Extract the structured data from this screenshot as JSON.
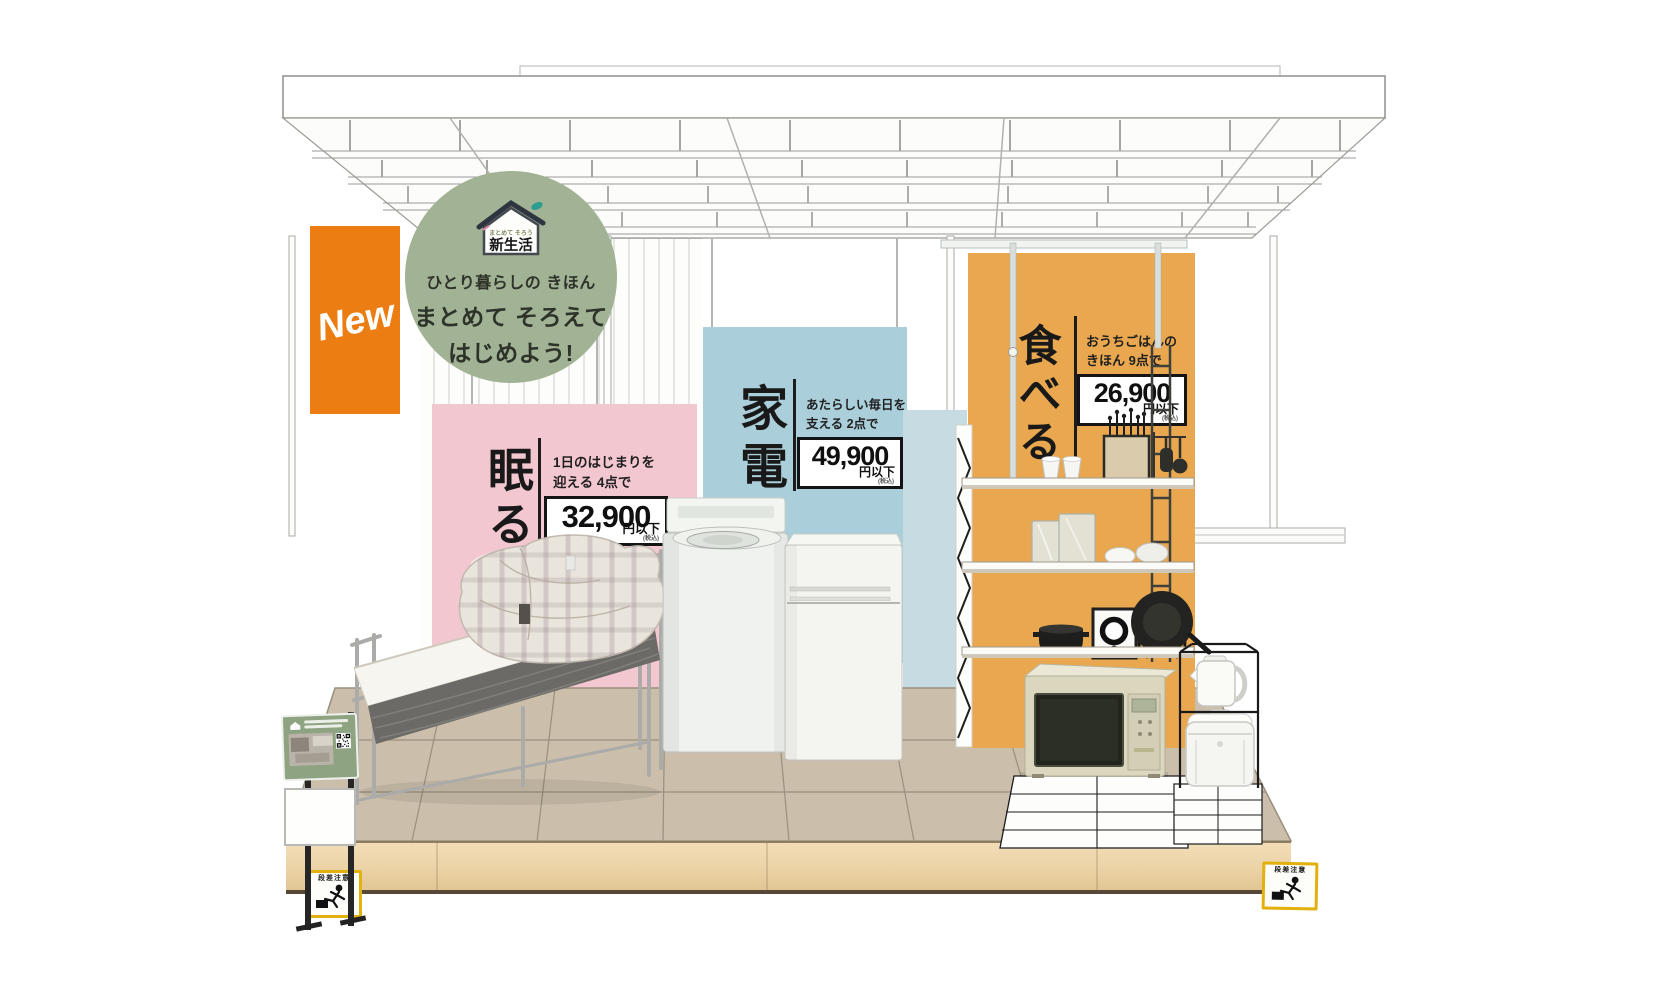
{
  "new_banner": {
    "label": "New"
  },
  "badge": {
    "logo_small": "まとめて そろう",
    "logo_main": "新生活",
    "tagline": "ひとり暮らしの きほん",
    "headline_line1": "まとめて そろえて",
    "headline_line2": "はじめよう!"
  },
  "sections": {
    "sleep": {
      "heading": "眠る",
      "desc1": "1日のはじまりを",
      "desc2": "迎える 4点で",
      "price": "32,900",
      "unit": "円以下",
      "tax": "(税込)"
    },
    "appliances": {
      "heading": "家電",
      "desc1": "あたらしい毎日を",
      "desc2": "支える 2点で",
      "price": "49,900",
      "unit": "円以下",
      "tax": "(税込)"
    },
    "eat": {
      "heading": "食べる",
      "desc1": "おうちごはんの",
      "desc2": "きほん 9点で",
      "price": "26,900",
      "unit": "円以下",
      "tax": "(税込)"
    }
  },
  "caution": {
    "label": "段差注意"
  },
  "colors": {
    "orange_accent": "#EC7D12",
    "badge_green": "#A1B394",
    "pink_panel": "#F3C7D0",
    "blue_panel": "#ABCFDA",
    "orange_panel": "#E9A84F",
    "caution_yellow": "#E2B10D",
    "floor_tile": "#CBBEAA",
    "wood_front": "#EDD7B0"
  }
}
